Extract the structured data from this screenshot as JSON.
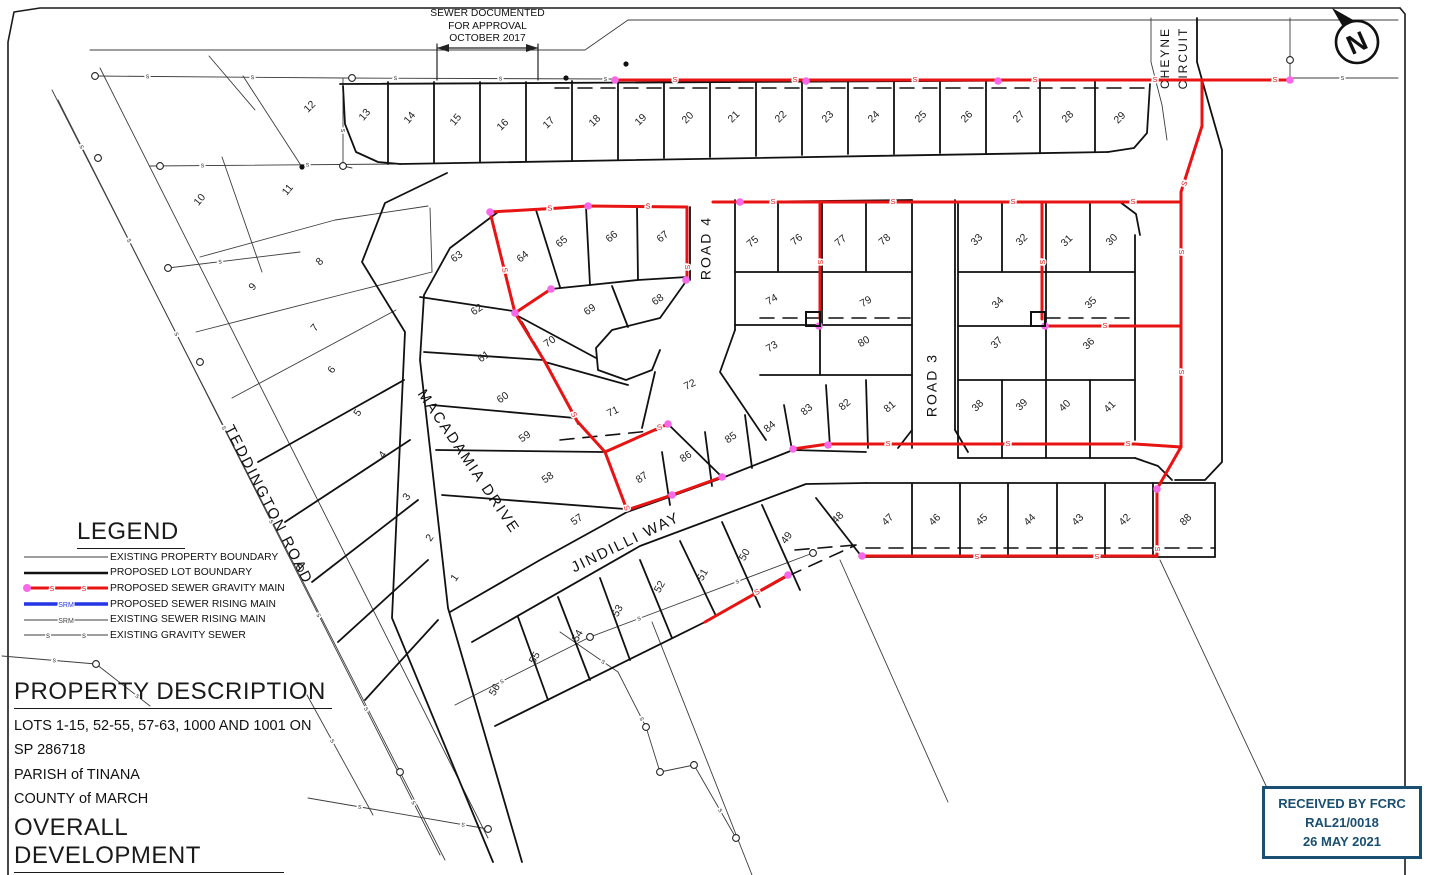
{
  "note": {
    "lines": [
      "SEWER DOCUMENTED",
      "FOR APPROVAL",
      "OCTOBER 2017"
    ]
  },
  "north_arrow": {
    "letter": "N"
  },
  "legend": {
    "title": "LEGEND",
    "items": [
      {
        "type": "existing-boundary",
        "label": "EXISTING PROPERTY BOUNDARY"
      },
      {
        "type": "proposed-boundary",
        "label": "PROPOSED LOT BOUNDARY"
      },
      {
        "type": "proposed-gravity",
        "label": "PROPOSED SEWER GRAVITY MAIN"
      },
      {
        "type": "proposed-rising",
        "label": "PROPOSED SEWER RISING MAIN"
      },
      {
        "type": "existing-rising",
        "label": "EXISTING SEWER RISING MAIN"
      },
      {
        "type": "existing-gravity",
        "label": "EXISTING GRAVITY SEWER"
      }
    ]
  },
  "property": {
    "title": "PROPERTY DESCRIPTION",
    "lines": [
      "LOTS 1-15, 52-55, 57-63, 1000 AND 1001 ON",
      "SP 286718",
      "PARISH of TINANA",
      "COUNTY of MARCH"
    ]
  },
  "development": {
    "title": "OVERALL DEVELOPMENT",
    "rows": [
      {
        "label": "TOTAL LOTS",
        "value": "73"
      }
    ]
  },
  "stamp": {
    "lines": [
      "RECEIVED BY FCRC",
      "RAL21/0018",
      "26 MAY 2021"
    ],
    "color": "#1b4f72"
  },
  "colors": {
    "red": "#e81313",
    "pink_node": "#f669e9",
    "blue": "#2335e5",
    "black": "#1a1a1a",
    "gray": "#444444"
  },
  "roads": [
    {
      "name": "TEDDINGTON ROAD",
      "x": 268,
      "y": 505,
      "rotate": 63,
      "size": 15
    },
    {
      "name": "MACADAMIA DRIVE",
      "x": 468,
      "y": 462,
      "rotate": 56,
      "size": 15
    },
    {
      "name": "JINDILLI WAY",
      "x": 626,
      "y": 543,
      "rotate": -26,
      "size": 15
    },
    {
      "name": "ROAD 4",
      "x": 707,
      "y": 248,
      "rotate": -90,
      "size": 14
    },
    {
      "name": "ROAD 3",
      "x": 933,
      "y": 385,
      "rotate": -90,
      "size": 14
    },
    {
      "name": "CHEYNE",
      "x": 1166,
      "y": 58,
      "rotate": -90,
      "size": 12
    },
    {
      "name": "CIRCUIT",
      "x": 1184,
      "y": 58,
      "rotate": -90,
      "size": 12
    }
  ],
  "lots": [
    {
      "n": "1",
      "x": 455,
      "y": 578,
      "r": -55
    },
    {
      "n": "2",
      "x": 430,
      "y": 538,
      "r": -55
    },
    {
      "n": "3",
      "x": 407,
      "y": 497,
      "r": -55
    },
    {
      "n": "4",
      "x": 383,
      "y": 455,
      "r": -55
    },
    {
      "n": "5",
      "x": 358,
      "y": 413,
      "r": -55
    },
    {
      "n": "6",
      "x": 332,
      "y": 370,
      "r": -55
    },
    {
      "n": "7",
      "x": 315,
      "y": 328,
      "r": -50
    },
    {
      "n": "8",
      "x": 320,
      "y": 262,
      "r": -45
    },
    {
      "n": "9",
      "x": 253,
      "y": 287,
      "r": -50
    },
    {
      "n": "10",
      "x": 200,
      "y": 200,
      "r": -50
    },
    {
      "n": "11",
      "x": 288,
      "y": 190,
      "r": -50
    },
    {
      "n": "12",
      "x": 310,
      "y": 107,
      "r": -45
    },
    {
      "n": "13",
      "x": 365,
      "y": 115,
      "r": -50
    },
    {
      "n": "14",
      "x": 410,
      "y": 118,
      "r": -50
    },
    {
      "n": "15",
      "x": 456,
      "y": 120,
      "r": -50
    },
    {
      "n": "16",
      "x": 503,
      "y": 125,
      "r": -45
    },
    {
      "n": "17",
      "x": 549,
      "y": 123,
      "r": -45
    },
    {
      "n": "18",
      "x": 595,
      "y": 121,
      "r": -45
    },
    {
      "n": "19",
      "x": 641,
      "y": 120,
      "r": -45
    },
    {
      "n": "20",
      "x": 688,
      "y": 118,
      "r": -45
    },
    {
      "n": "21",
      "x": 734,
      "y": 117,
      "r": -45
    },
    {
      "n": "22",
      "x": 781,
      "y": 117,
      "r": -45
    },
    {
      "n": "23",
      "x": 828,
      "y": 117,
      "r": -45
    },
    {
      "n": "24",
      "x": 874,
      "y": 117,
      "r": -45
    },
    {
      "n": "25",
      "x": 921,
      "y": 117,
      "r": -45
    },
    {
      "n": "26",
      "x": 967,
      "y": 117,
      "r": -45
    },
    {
      "n": "27",
      "x": 1019,
      "y": 117,
      "r": -45
    },
    {
      "n": "28",
      "x": 1068,
      "y": 117,
      "r": -45
    },
    {
      "n": "29",
      "x": 1120,
      "y": 118,
      "r": -45
    },
    {
      "n": "30",
      "x": 1112,
      "y": 240,
      "r": -45
    },
    {
      "n": "31",
      "x": 1067,
      "y": 241,
      "r": -45
    },
    {
      "n": "32",
      "x": 1022,
      "y": 240,
      "r": -45
    },
    {
      "n": "33",
      "x": 977,
      "y": 240,
      "r": -45
    },
    {
      "n": "34",
      "x": 998,
      "y": 303,
      "r": -45
    },
    {
      "n": "35",
      "x": 1091,
      "y": 303,
      "r": -45
    },
    {
      "n": "36",
      "x": 1089,
      "y": 344,
      "r": -45
    },
    {
      "n": "37",
      "x": 997,
      "y": 343,
      "r": -45
    },
    {
      "n": "38",
      "x": 978,
      "y": 406,
      "r": -45
    },
    {
      "n": "39",
      "x": 1022,
      "y": 405,
      "r": -45
    },
    {
      "n": "40",
      "x": 1065,
      "y": 406,
      "r": -45
    },
    {
      "n": "41",
      "x": 1110,
      "y": 407,
      "r": -45
    },
    {
      "n": "42",
      "x": 1125,
      "y": 520,
      "r": -45
    },
    {
      "n": "43",
      "x": 1078,
      "y": 520,
      "r": -45
    },
    {
      "n": "44",
      "x": 1030,
      "y": 520,
      "r": -45
    },
    {
      "n": "45",
      "x": 982,
      "y": 520,
      "r": -45
    },
    {
      "n": "46",
      "x": 935,
      "y": 520,
      "r": -45
    },
    {
      "n": "47",
      "x": 888,
      "y": 520,
      "r": -45
    },
    {
      "n": "48",
      "x": 838,
      "y": 518,
      "r": -45
    },
    {
      "n": "49",
      "x": 787,
      "y": 538,
      "r": -55
    },
    {
      "n": "50",
      "x": 745,
      "y": 555,
      "r": -60
    },
    {
      "n": "51",
      "x": 703,
      "y": 575,
      "r": -60
    },
    {
      "n": "52",
      "x": 660,
      "y": 587,
      "r": -60
    },
    {
      "n": "53",
      "x": 618,
      "y": 611,
      "r": -60
    },
    {
      "n": "54",
      "x": 578,
      "y": 636,
      "r": -60
    },
    {
      "n": "55",
      "x": 535,
      "y": 658,
      "r": -60
    },
    {
      "n": "56",
      "x": 495,
      "y": 690,
      "r": -60
    },
    {
      "n": "57",
      "x": 577,
      "y": 520,
      "r": -35
    },
    {
      "n": "58",
      "x": 548,
      "y": 478,
      "r": -35
    },
    {
      "n": "59",
      "x": 525,
      "y": 437,
      "r": -35
    },
    {
      "n": "60",
      "x": 503,
      "y": 398,
      "r": -35
    },
    {
      "n": "61",
      "x": 484,
      "y": 357,
      "r": -35
    },
    {
      "n": "62",
      "x": 477,
      "y": 310,
      "r": -35
    },
    {
      "n": "63",
      "x": 457,
      "y": 257,
      "r": -35
    },
    {
      "n": "64",
      "x": 523,
      "y": 257,
      "r": -40
    },
    {
      "n": "65",
      "x": 562,
      "y": 242,
      "r": -40
    },
    {
      "n": "66",
      "x": 612,
      "y": 237,
      "r": -40
    },
    {
      "n": "67",
      "x": 663,
      "y": 237,
      "r": -40
    },
    {
      "n": "68",
      "x": 658,
      "y": 300,
      "r": -35
    },
    {
      "n": "69",
      "x": 590,
      "y": 310,
      "r": -35
    },
    {
      "n": "70",
      "x": 550,
      "y": 342,
      "r": -35
    },
    {
      "n": "71",
      "x": 613,
      "y": 412,
      "r": -25
    },
    {
      "n": "72",
      "x": 690,
      "y": 385,
      "r": -25
    },
    {
      "n": "73",
      "x": 772,
      "y": 347,
      "r": -30
    },
    {
      "n": "74",
      "x": 772,
      "y": 300,
      "r": -30
    },
    {
      "n": "75",
      "x": 753,
      "y": 242,
      "r": -40
    },
    {
      "n": "76",
      "x": 797,
      "y": 240,
      "r": -40
    },
    {
      "n": "77",
      "x": 841,
      "y": 241,
      "r": -40
    },
    {
      "n": "78",
      "x": 885,
      "y": 240,
      "r": -40
    },
    {
      "n": "79",
      "x": 866,
      "y": 302,
      "r": -30
    },
    {
      "n": "80",
      "x": 864,
      "y": 342,
      "r": -30
    },
    {
      "n": "81",
      "x": 890,
      "y": 407,
      "r": -40
    },
    {
      "n": "82",
      "x": 845,
      "y": 405,
      "r": -40
    },
    {
      "n": "83",
      "x": 807,
      "y": 410,
      "r": -40
    },
    {
      "n": "84",
      "x": 770,
      "y": 427,
      "r": -40
    },
    {
      "n": "85",
      "x": 731,
      "y": 438,
      "r": -35
    },
    {
      "n": "86",
      "x": 686,
      "y": 457,
      "r": -35
    },
    {
      "n": "87",
      "x": 642,
      "y": 478,
      "r": -35
    },
    {
      "n": "88",
      "x": 1186,
      "y": 520,
      "r": -45
    }
  ],
  "plan": {
    "frame": [
      "1400,8 40,8 14,12 8,42 8,875",
      "1400,8 1405,14 1405,875"
    ],
    "thick_lines": [
      "340,84 1148,80",
      "343,86 345,124 356,152 378,162 400,164",
      "400,164 1108,152",
      "1108,152 1134,148 1147,133 1150,84",
      "388,82 388,164",
      "434,82 434,163",
      "480,82 480,162",
      "526,82 526,161",
      "572,81 572,160",
      "618,81 618,159",
      "664,81 664,158",
      "710,81 710,157",
      "756,81 756,156",
      "802,81 802,155",
      "848,81 848,154",
      "894,80 894,154",
      "940,80 940,153",
      "986,80 986,153",
      "1040,80 1040,152",
      "1095,80 1095,152",
      "258,462 404,380",
      "285,522 410,440",
      "312,582 418,500",
      "338,642 428,560",
      "365,700 438,620",
      "447,173 385,203 362,262 405,332 392,618 493,862",
      "498,212 450,248 424,295 420,360 448,608 522,862",
      "450,612 540,560 627,512 672,496 722,478 793,450",
      "793,450 866,452",
      "958,458 1135,458",
      "1135,458 1158,466 1172,480",
      "472,642 640,546 806,484 866,483",
      "866,483 1215,483",
      "862,557 1215,557",
      "816,498 862,557",
      "1215,483 1215,557",
      "912,483 912,557",
      "960,483 960,557",
      "1008,483 1008,557",
      "1057,483 1057,557",
      "1105,483 1105,557",
      "1153,483 1153,557",
      "495,726 705,622",
      "705,622 788,576",
      "762,505 800,590",
      "722,522 760,607",
      "680,541 716,616",
      "640,560 672,638",
      "600,578 630,660",
      "558,597 590,680",
      "518,617 548,700",
      "420,297 513,311",
      "424,352 543,360",
      "432,405 575,418",
      "436,450 603,452",
      "442,495 625,509",
      "490,212 588,206 687,207",
      "536,210 560,287",
      "586,207 590,285",
      "637,207 638,280",
      "687,207 687,277",
      "515,313 551,289",
      "551,289 590,285 638,280 687,277",
      "612,286 628,327",
      "518,316 596,358",
      "545,362 628,385",
      "655,372 642,428",
      "687,280 660,318 612,330 596,348 598,370 626,380 652,370 660,350",
      "690,207 690,280",
      "735,200 735,330",
      "735,330 720,372 766,440",
      "605,452 668,424",
      "668,424 722,477",
      "784,405 792,450",
      "745,415 752,468",
      "705,432 712,486",
      "662,452 670,505",
      "826,385 830,447",
      "866,380 868,448",
      "735,202 912,200",
      "735,272 912,272",
      "735,325 912,325",
      "760,375 912,375",
      "778,202 778,272",
      "866,202 866,272",
      "822,202 822,272",
      "822,272 822,325",
      "820,325 820,375",
      "912,200 912,448",
      "955,200 955,430",
      "912,430 898,448",
      "955,430 968,452",
      "958,202 1120,202",
      "1120,202 1136,214 1140,235",
      "958,202 958,458",
      "1046,202 1046,458",
      "1002,202 1002,272",
      "1090,202 1090,272",
      "1002,380 1002,458",
      "1090,380 1090,458",
      "958,272 1135,272",
      "958,326 1135,326",
      "958,380 1135,380",
      "1135,235 1135,440",
      "1197,18 1197,62 1210,108 1222,150 1222,462 1205,480 1175,480"
    ],
    "thin_lines": [
      "52,90 445,860",
      "100,68 488,838",
      "90,50 585,50 628,20",
      "628,20 1398,20",
      "243,76 302,167",
      "222,157 262,272",
      "200,257 335,220 428,206",
      "430,208 432,272",
      "352,292 432,272",
      "196,332 352,292",
      "232,398 396,310",
      "209,56 255,110",
      "840,560 948,802",
      "1160,560 1268,790",
      "652,622 752,875",
      "1151,18 1151,62 1162,105 1167,140",
      "1290,18 1290,78"
    ],
    "dashed_lines": [
      "555,88 1148,88",
      "866,548 1215,548",
      "795,550 856,545",
      "1046,318 1135,318",
      "760,318 910,318",
      "522,322 548,366 578,424",
      "560,440 660,430",
      "788,576 856,545"
    ],
    "red_lines": [
      "615,80 1290,80",
      "1202,80 1202,126 1181,192 1181,447 1157,489 1157,556 864,556",
      "713,202 1181,202",
      "490,212 560,208 588,206 687,207 687,280",
      "490,212 515,313",
      "515,313 551,289",
      "515,313 545,362 577,421 605,452 627,510 672,495 722,477",
      "605,452 668,424",
      "820,202 820,319",
      "1042,202 1042,319",
      "1045,326 1181,326",
      "793,449 828,444 1135,444 1181,447",
      "705,622 788,575"
    ],
    "sewer_existing": [
      "95,76 343,78 612,79",
      "343,78 343,166 352,168",
      "58,100 440,855",
      "150,166 398,164",
      "168,268 300,252",
      "455,705 590,637 813,553",
      "560,632 618,672 646,727 660,772 694,765 736,838",
      "307,695 373,815",
      "308,798 488,829",
      "2,656 96,664 150,706",
      "1290,78 1398,78"
    ],
    "manholes": [
      [
        95,
        76
      ],
      [
        352,
        78
      ],
      [
        160,
        166
      ],
      [
        343,
        166
      ],
      [
        168,
        268
      ],
      [
        98,
        158
      ],
      [
        200,
        362
      ],
      [
        300,
        568
      ],
      [
        400,
        772
      ],
      [
        590,
        637
      ],
      [
        813,
        553
      ],
      [
        646,
        727
      ],
      [
        660,
        772
      ],
      [
        694,
        765
      ],
      [
        488,
        829
      ],
      [
        736,
        838
      ],
      [
        96,
        664
      ],
      [
        1290,
        60
      ]
    ],
    "black_dots": [
      [
        566,
        78
      ],
      [
        302,
        167
      ],
      [
        626,
        64
      ]
    ],
    "red_nodes": [
      [
        615,
        80
      ],
      [
        806,
        81
      ],
      [
        998,
        81
      ],
      [
        1290,
        80
      ],
      [
        740,
        202
      ],
      [
        490,
        212
      ],
      [
        588,
        206
      ],
      [
        686,
        280
      ],
      [
        515,
        313
      ],
      [
        551,
        289
      ],
      [
        668,
        424
      ],
      [
        672,
        495
      ],
      [
        722,
        477
      ],
      [
        788,
        575
      ],
      [
        793,
        449
      ],
      [
        828,
        445
      ],
      [
        862,
        556
      ],
      [
        1045,
        326
      ],
      [
        819,
        326
      ],
      [
        1157,
        489
      ]
    ],
    "structures": [
      [
        813,
        319
      ],
      [
        1038,
        319
      ]
    ],
    "dimension": {
      "bar": "437,48 538,48",
      "ext1": "437,44 437,80",
      "ext2": "538,44 538,80"
    }
  }
}
